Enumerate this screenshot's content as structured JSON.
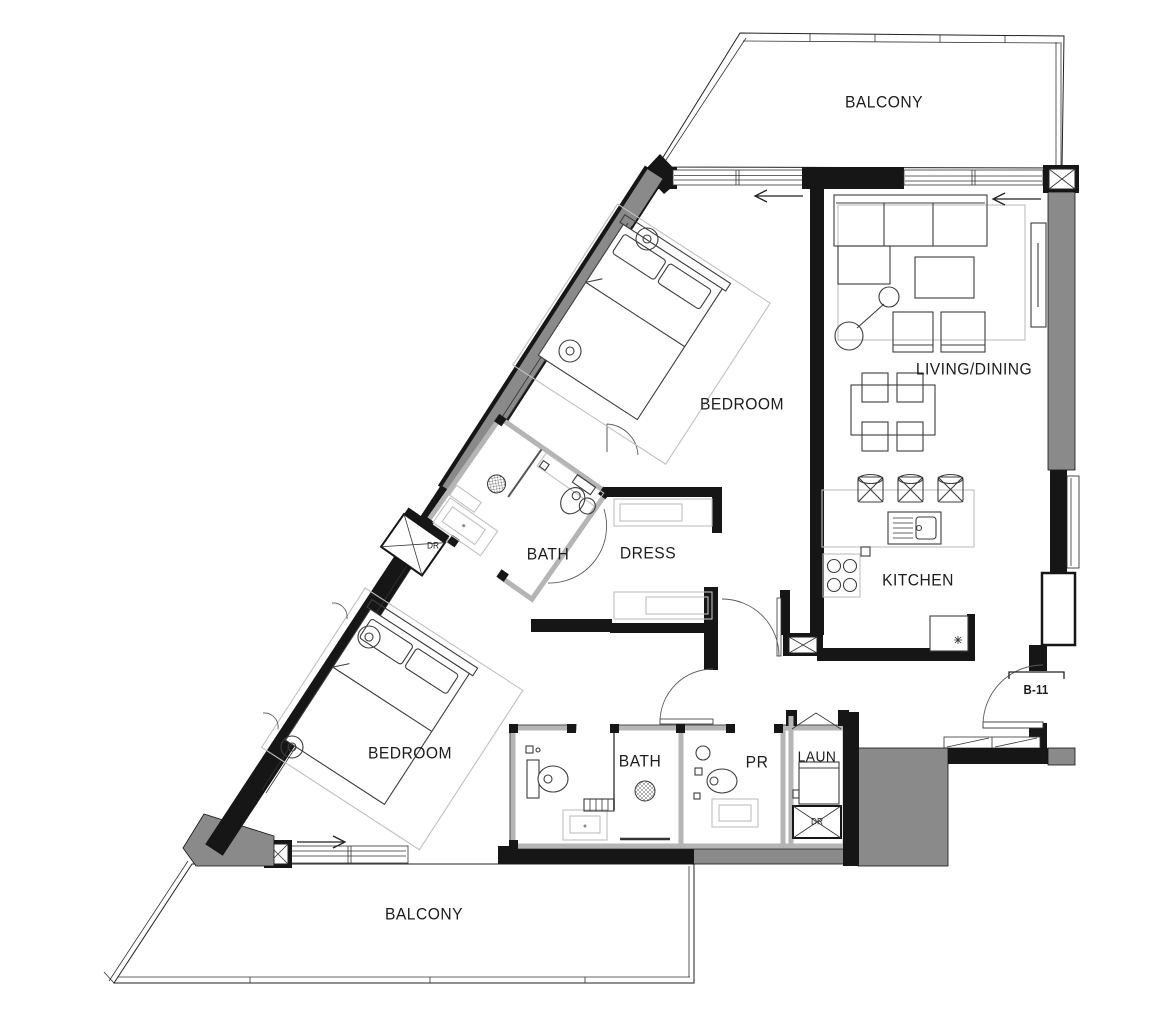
{
  "floor_plan": {
    "rooms": {
      "balcony_top": {
        "label": "BALCONY"
      },
      "living_dining": {
        "label": "LIVING/DINING"
      },
      "bedroom_top": {
        "label": "BEDROOM"
      },
      "bath_top": {
        "label": "BATH"
      },
      "dress": {
        "label": "DRESS"
      },
      "kitchen": {
        "label": "KITCHEN"
      },
      "bedroom_bottom": {
        "label": "BEDROOM"
      },
      "bath_bottom": {
        "label": "BATH"
      },
      "powder_room": {
        "label": "PR"
      },
      "laundry": {
        "label": "LAUN"
      },
      "balcony_bottom": {
        "label": "BALCONY"
      }
    },
    "annotations": {
      "unit_number": "B-11",
      "dryer_upper": "DR",
      "dryer_lower": "DR"
    },
    "colors": {
      "wall_black": "#161616",
      "wall_gray": "#8a8a8a",
      "wall_light": "#b5b5b5",
      "text": "#1c1c1c"
    }
  }
}
